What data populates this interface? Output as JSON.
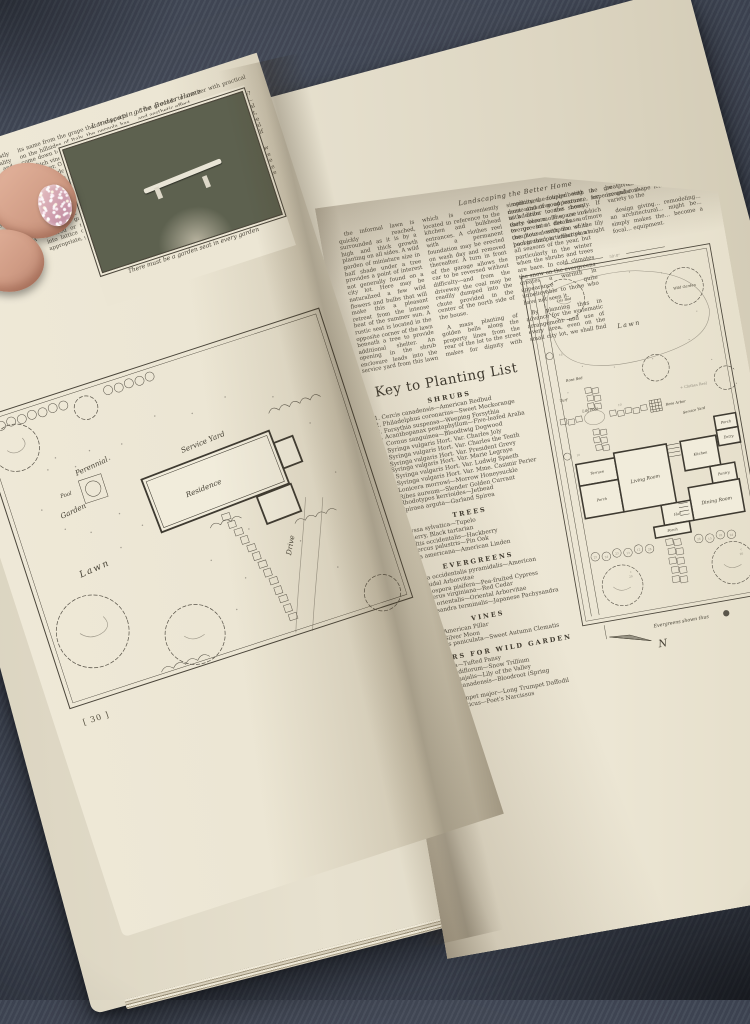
{
  "magazine": {
    "running_header": "Landscaping the Better Home",
    "left_page": {
      "page_number": "[ 30 ]",
      "photo_caption": "There must be a garden seat in every garden",
      "columns": [
        "The small garden houses are mostly covered seats of some type or in reality tea houses, depending on the size and use of the grounds. They should be related to the general plan of the property. Generally the place of a garden house is as a focal point at the end of a garden axis, or to mark the transition between two garden areas. Never should they be isolated in the center of a lawn or other open space bearing no particular relationship to the scheme as a whole.",
        "How many times we see the pergola misused, trying to take the place of a garden house when it really is a passageway between two areas. Taking its name from the grape that it supports on the hillsides of Italy, the pergola has come down to us as a series of columns on which vines may be trained to form a leafy cover. Often we see it standing free in the garden with no beginning and ending where some simple covered seat would have served far better.",
        "affairs that, particularly in the winter-time, stand out stark, unsupported, alone in a vast area of brown earth with no apparent reason for being. These gates and gateways, however, whether covered or not, which are introduced into lattice or picket fences, are most appropriate, giving access from one part of the grounds to another with practical and aesthetic effect.",
        "How shall we determine which to use? There is only one real criterion—simplicity. Not only must the structural members that go to make the seat, gateway, or buildings, be simple and free from intricate moldings, but the general design and shape of the structure itself must be as simple",
        "The lily pool and garden on the brow of the hill lie plainly in direct view of the terrace, the area with its charming use of choice planting giving privacy to the out-of-door living room provided by the garden close at hand."
      ],
      "plan": {
        "labels": {
          "perennial": "Perennial",
          "garden": "Garden",
          "pool": "Pool",
          "service_yard": "Service Yard",
          "residence": "Residence",
          "lawn": "Lawn",
          "drive": "Drive"
        }
      }
    },
    "right_page": {
      "page_number": "[ 31 ]",
      "paragraphs": [
        "the informal lawn is quickly reached, surrounded as it is by a high and thick growth planting on all sides. A wild garden of miniature size in half shade under a tree provides a point of interest not generally found on a city lot. Here may be naturalized a few wild flowers and bulbs that will make this a pleasant retreat from the intense heat of the summer sun. A rustic seat is located in the opposite corner of the lawn beneath a tree to provide additional shelter. An opening in the shrub enclosure leads into the service yard from this lawn which is conveniently located in reference to the kitchen and bulkhead entrances. A clothes reel with a permanent foundation may be erected on wash day and removed thereafter. A turn in front of the garage allows the car to be reversed without difficulty—and from the driveway the coal may be readily dumped into the chute provided in the center of the north side of the house.",
        "A mass planting of golden bells along the property lines from the rear of the lot to the street makes for dignity with simplicity, the foliage being dense and of good texture, in addition to the showy early bloom. The use of evergreens at the base of the house with its white background is effective at all seasons of the year, but particularly in the winter when the shrubs and trees are bare. In cold climates the snow on the evergreens creates a warmth in appearance quite unbelievable to those who have not seen it.",
        "By planning thus in advance for the systematic arrangement and use of every area, even on the small city lot, we shall find a great economy in expense and con—",
        "continues, coupled with the most attractive appearance, for with order comes beauty. If there were more space in which to go into details a more complete description of the lily pool in this particular plan might be given. The more or less irregular shape lends charming variety to the",
        "design giving… remodeling… an architectural… might be… simply makes the… become a focal… equipment."
      ],
      "key_title": "Key to Planting List",
      "sections": [
        {
          "heading": "SHRUBS",
          "items": [
            "1. Cercis canadensis—American Redbud",
            "2. Philadelphus coronarius—Sweet Mockorange",
            "3. Forsythia suspensa—Weeping Forsythia",
            "4. Acanthopanax pentaphyllum—Five-leafed Aralia",
            "5. Cornus sanguinea—Bloodtwig Dogwood",
            "6. Syringa vulgaris Hort. Var. Charles Joly",
            "7. Syringa vulgaris Hort. Var. Charles the Tenth",
            "8. Syringa vulgaris Hort. Var. President Grevy",
            "9. Syringa vulgaris Hort. Var. Marie Legraye",
            "10. Syringa vulgaris Hort. Var. Ludwig Spaeth",
            "11. Syringa vulgaris Hort. Var. Mme. Casimir Perier",
            "12. Lonicera morrowi—Morrow Honeysuckle",
            "13. Ribes aureum—Slender Golden Currant",
            "14. Rhodotypos kerrioides—Jetbead",
            "15. Spiraea arguta—Garland Spirea"
          ]
        },
        {
          "heading": "TREES",
          "items": [
            "16. Nyssa sylvatica—Tupelo",
            "17. Cherry, Black tartarian",
            "18. Celtis occidentalis—Hackberry",
            "19. Quercus palustris—Pin Oak",
            "20. Tilia americana—American Linden"
          ]
        },
        {
          "heading": "EVERGREENS",
          "items": [
            "21. Thuja occidentalis pyramidalis—American pyramidal Arborvitae",
            "22. Retinospora pisifera—Pea-fruited Cypress",
            "23. Juniperus virginiana—Red Cedar",
            "24. Thuja orientalis—Oriental Arborvitae",
            "25. Pachysandra terminalis—Japanese Pachysandra"
          ]
        },
        {
          "heading": "VINES",
          "items": [
            "26. Rosa—American Pillar",
            "27. Rosa—Silver Moon",
            "28. Clematis paniculata—Sweet Autumn Clematis"
          ]
        },
        {
          "heading": "FLOWERS FOR WILD GARDEN",
          "items": [
            "Viola cornuta—Tufted Pansy",
            "Trillium grandiflorum—Snow Trillium",
            "Convallaria majalis—Lily of the Valley",
            "Sanguinaria canadensis—Bloodroot (Spring flowering)",
            "Narcissus trumpet major—Long Trumpet Daffodil",
            "Narcissus poeticus—Poet's Narcissus"
          ]
        }
      ],
      "plan": {
        "dimension_top": "50'-0\"",
        "dimension_walk": "10'",
        "labels": {
          "iris_bed": "Iris Bed",
          "wild_garden": "Wild Garden",
          "lawn": "Lawn",
          "rose_bed": "Rose Bed",
          "turf": "Turf",
          "lily_pool": "Lily Pool",
          "rose_arbor": "Rose Arbor",
          "service_yard": "Service Yard",
          "clothes_reel": "+ Clothes Reel",
          "terrace": "Terrace",
          "porch": "Porch",
          "living_room": "Living Room",
          "kitchen": "Kitchen",
          "entry": "Entry",
          "pantry": "Pantry",
          "dining_room": "Dining Room",
          "hall": "Hall"
        },
        "tree_qty_letter": "c",
        "tree_qty_number": "20",
        "shrub_numbers": [
          "25",
          "24",
          "23",
          "13",
          "12",
          "28",
          "26",
          "15",
          "18",
          "24"
        ],
        "strip_numbers": [
          "16",
          "10"
        ],
        "evergreen_note": "Evergreens shown thus",
        "north_label": "N"
      }
    }
  }
}
